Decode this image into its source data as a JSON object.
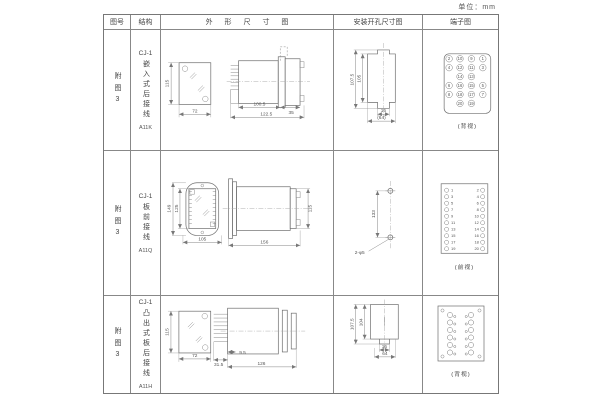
{
  "unit_label": "单位：mm",
  "header": {
    "fig_no": "图号",
    "structure": "结构",
    "outline": "外 形 尺 寸 图",
    "mounting": "安装开孔尺寸图",
    "terminal": "端子图"
  },
  "rows": [
    {
      "fig_no": "附图3",
      "model": "CJ-1",
      "structure": "嵌入式后接线",
      "code": "A11K",
      "outline": {
        "front_h": "115",
        "front_w": "72",
        "len_body": "100.5",
        "flange": "35",
        "len_total": "122.5"
      },
      "mounting": {
        "outer_h": "107.5",
        "inner_h": "105",
        "tab_w": "16",
        "span": "(64)"
      },
      "terminal": {
        "caption": "(背视)",
        "layout": "back-4col",
        "grid": [
          [
            "2",
            "10",
            "9",
            "1"
          ],
          [
            "4",
            "12",
            "11",
            "3"
          ],
          [
            "",
            "14",
            "13",
            ""
          ],
          [
            "6",
            "16",
            "15",
            "5"
          ],
          [
            "8",
            "18",
            "17",
            "7"
          ],
          [
            "",
            "20",
            "19",
            ""
          ]
        ]
      }
    },
    {
      "fig_no": "附图3",
      "model": "CJ-1",
      "structure": "板前接线",
      "code": "A11Q",
      "outline": {
        "front_h_outer": "149",
        "front_h_inner": "125",
        "front_w": "105",
        "len_total": "156",
        "side_h": "115"
      },
      "mounting": {
        "hole_spacing": "133",
        "hole_label": "2-φ5"
      },
      "terminal": {
        "caption": "(前视)",
        "layout": "front-2col",
        "pairs": [
          [
            "1",
            "2"
          ],
          [
            "3",
            "4"
          ],
          [
            "5",
            "6"
          ],
          [
            "7",
            "8"
          ],
          [
            "9",
            "10"
          ],
          [
            "11",
            "12"
          ],
          [
            "13",
            "14"
          ],
          [
            "15",
            "16"
          ],
          [
            "17",
            "18"
          ],
          [
            "19",
            "20"
          ]
        ]
      }
    },
    {
      "fig_no": "附图3",
      "model": "CJ-1",
      "structure": "凸出式板后接线",
      "code": "A11H",
      "outline": {
        "front_h": "115",
        "front_w": "72",
        "comb": "31.5",
        "offset": "9.5",
        "len_total": "126"
      },
      "mounting": {
        "outer_h": "107.5",
        "inner_h": "104",
        "tab_w": "16",
        "span": "64"
      },
      "terminal": {
        "caption": "(背视)",
        "layout": "back-screws",
        "rows": 6,
        "cols": 2
      }
    }
  ]
}
